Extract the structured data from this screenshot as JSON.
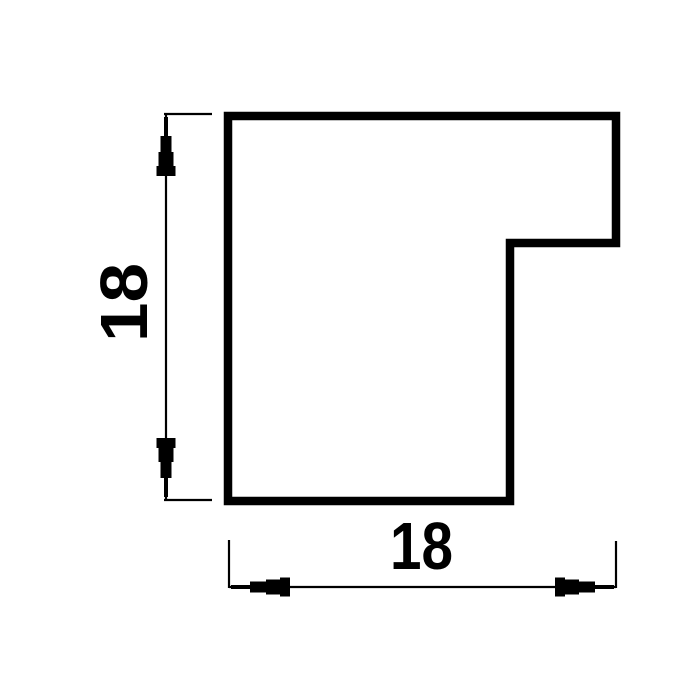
{
  "page": {
    "background_color": "#ffffff"
  },
  "diagram": {
    "kind": "technical-dimension-drawing",
    "subject": "moulding-profile-cross-section",
    "colors": {
      "line": "#000000",
      "profile_fill": "#ffffff"
    },
    "profile": {
      "outline_path": "M 228 116 L 616 116 L 616 243 L 510 243 L 510 501 L 228 501 Z",
      "stroke_width": "8.5"
    },
    "dimensions": {
      "height": {
        "label": "18",
        "orientation": "vertical"
      },
      "width": {
        "label": "18",
        "orientation": "horizontal"
      }
    }
  }
}
